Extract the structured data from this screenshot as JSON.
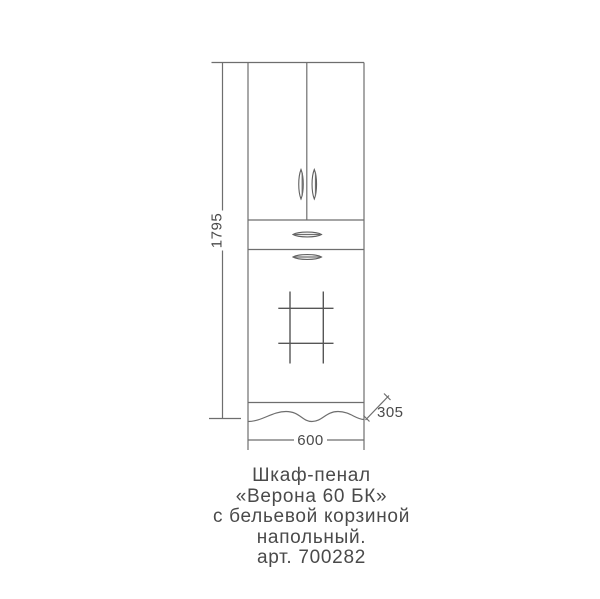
{
  "drawing": {
    "title": "furniture technical drawing",
    "dimensions": {
      "height_label": "1795",
      "width_label": "600",
      "depth_label": "305"
    },
    "caption": {
      "lines": [
        "Шкаф-пенал",
        "«Верона 60 БК»",
        "с бельевой корзиной",
        "напольный.",
        "арт. 700282"
      ]
    },
    "colors": {
      "line": "#6e6e6e",
      "grid_line": "#565656",
      "text": "#4a4a4a",
      "background": "#ffffff"
    }
  }
}
